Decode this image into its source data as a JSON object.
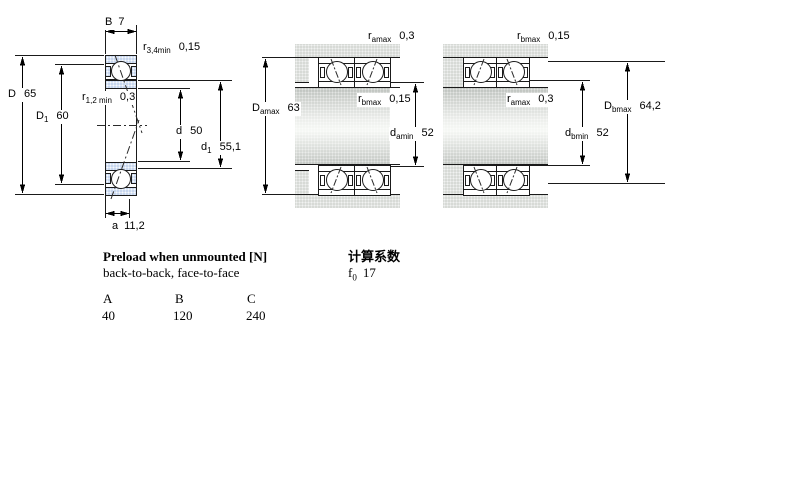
{
  "diagram_labels": {
    "left": {
      "B": {
        "base": "B",
        "sub": "",
        "value": "7"
      },
      "r34": {
        "base": "r",
        "sub": "3,4min",
        "value": "0,15"
      },
      "D": {
        "base": "D",
        "sub": "",
        "value": "65"
      },
      "D1": {
        "base": "D",
        "sub": "1",
        "value": "60"
      },
      "r12": {
        "base": "r",
        "sub": "1,2 min",
        "value": "0,3"
      },
      "d": {
        "base": "d",
        "sub": "",
        "value": "50"
      },
      "d1": {
        "base": "d",
        "sub": "1",
        "value": "55,1"
      },
      "a": {
        "base": "a",
        "sub": "",
        "value": "11,2"
      }
    },
    "middle": {
      "ramax": {
        "base": "r",
        "sub": "amax",
        "value": "0,3"
      },
      "Damax": {
        "base": "D",
        "sub": "amax",
        "value": "63"
      },
      "rbmax": {
        "base": "r",
        "sub": "bmax",
        "value": "0,15"
      },
      "damin": {
        "base": "d",
        "sub": "amin",
        "value": "52"
      }
    },
    "right": {
      "rbmax": {
        "base": "r",
        "sub": "bmax",
        "value": "0,15"
      },
      "ramax": {
        "base": "r",
        "sub": "amax",
        "value": "0,3"
      },
      "Dbmax": {
        "base": "D",
        "sub": "bmax",
        "value": "64,2"
      },
      "dbmin": {
        "base": "d",
        "sub": "bmin",
        "value": "52"
      }
    }
  },
  "preload": {
    "title": "Preload when unmounted [N]",
    "subtitle": "back-to-back, face-to-face",
    "columns": [
      "A",
      "B",
      "C"
    ],
    "values": [
      "40",
      "120",
      "240"
    ]
  },
  "calculation": {
    "title": "计算系数",
    "factor": {
      "base": "f",
      "sub": "0",
      "value": "17"
    }
  },
  "colors": {
    "bearing_fill": "#c7d6ee",
    "steel_fill": "#d7dad6",
    "line": "#000000"
  }
}
